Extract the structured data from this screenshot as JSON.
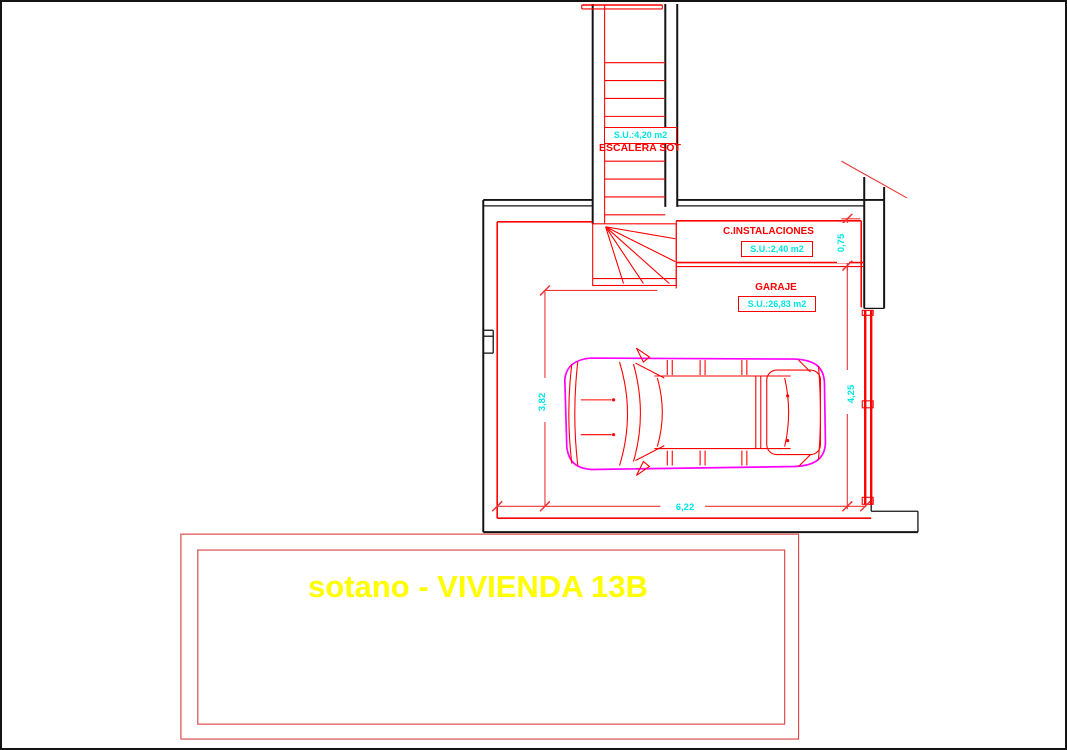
{
  "colors": {
    "black": "#141414",
    "red": "#ff0000",
    "dim-red": "#ef3434",
    "frame-red": "#d94f4f",
    "cyan": "#00e5e5",
    "magenta": "#ff00ff",
    "yellow": "#ffff00"
  },
  "plan": {
    "stair": {
      "area": "S.U.:4,20 m2",
      "name": "ESCALERA SOT"
    },
    "instalaciones": {
      "name": "C.INSTALACIONES",
      "area": "S.U.:2,40 m2"
    },
    "garaje": {
      "name": "GARAJE",
      "area": "S.U.:26,83 m2"
    },
    "dims": {
      "instalaciones_depth": "0,75",
      "garage_height_left": "3,82",
      "garage_height_right": "4,25",
      "garage_width_bottom": "6,22"
    }
  },
  "title_block": {
    "label": "sotano - VIVIENDA 13B"
  }
}
